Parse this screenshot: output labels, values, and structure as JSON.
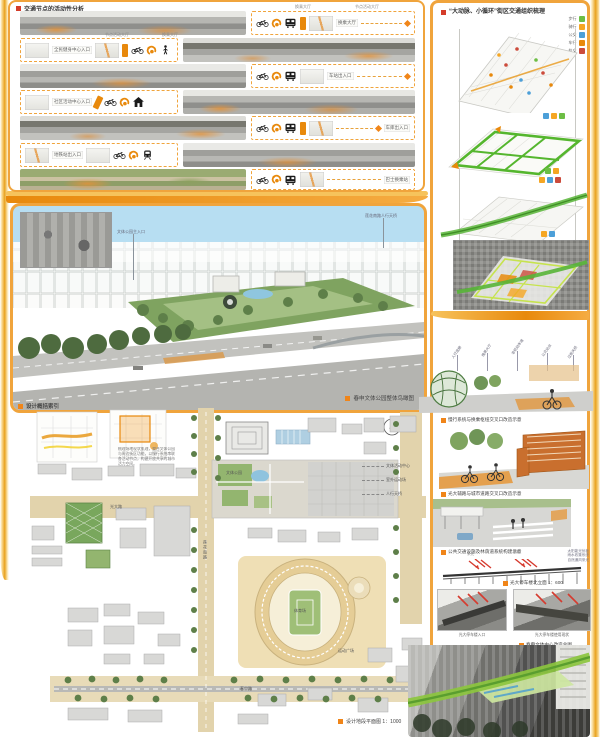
{
  "colors": {
    "accent_orange": "#F0A43C",
    "deep_orange": "#E8890C",
    "caption_square": "#F08519",
    "title_red": "#D43C2A",
    "legend_green": "#6DBE45",
    "legend_orange": "#F5A623",
    "legend_blue": "#4C9FD8",
    "legend_deep_orange": "#E8890C",
    "legend_red": "#CC4B3B",
    "greenway_green": "#58B537"
  },
  "top_panel": {
    "title": "交通节点的活动性分析",
    "rows": [
      {
        "label": "换乘大厅",
        "icons": [
          "bike",
          "dial",
          "bus"
        ],
        "top_labels": [
          "换乘大厅",
          "节点活动大厅"
        ]
      },
      {
        "label": "全民健身中心入口",
        "icons": [
          "bike",
          "dial",
          "walk"
        ],
        "top_labels": [
          "节点活动大厅",
          "换乘大厅"
        ]
      },
      {
        "label": "车站出入口",
        "icons": [
          "bike",
          "dial",
          "bus"
        ]
      },
      {
        "label": "社区活动中心入口",
        "icons": [
          "bike",
          "dial",
          "home"
        ]
      },
      {
        "label": "车库出入口",
        "icons": [
          "bike",
          "dial",
          "bus"
        ]
      },
      {
        "label": "地铁站出入口",
        "icons": [
          "bike",
          "dial",
          "train"
        ]
      },
      {
        "label": "巴士换乘站",
        "icons": [
          "bike",
          "dial",
          "bus"
        ]
      }
    ]
  },
  "aerial": {
    "caption": "春申文体公园整体鸟瞰图",
    "annotations": [
      "莲花南路人行天桥",
      "文体公园主入口"
    ]
  },
  "plan": {
    "index_title": "设计概括索引",
    "paragraph": "梳理场地现状肌理，整合文体公园与周边街区功能，以慢行系统串联各活动节点，构建开放共享的城市活力空间。",
    "caption": "设计地段平面图 1：1000",
    "labels": {
      "leader1": "文体活动中心",
      "leader2": "室外运动场",
      "leader3": "人行天桥",
      "road_v": "莲花南路",
      "road_h": "光大路",
      "road_b": "春申路",
      "stadium": "体育场",
      "plaza": "运动广场",
      "park": "文体公园"
    }
  },
  "right_col": {
    "title": "“大动脉、小循环”街区交通组织梳理",
    "legend": [
      {
        "label": "步行"
      },
      {
        "label": "骑行"
      },
      {
        "label": "公交"
      },
      {
        "label": "车行"
      },
      {
        "label": "轨交"
      }
    ],
    "leaders": [
      "人行连廊",
      "换乘大厅",
      "非机动车道",
      "公交站台",
      "过街天桥"
    ],
    "captions": {
      "c1": "慢行系统与换乘枢纽交叉口改造示意",
      "c2": "光大辅路与城市道路交叉口改造示意",
      "c3": "公共交通设施及林荫道系统构建示意",
      "c4": "光大停车楼北立面 1：600",
      "c5": "春申文体中心改造总图"
    },
    "section": {
      "arrow_label_1": "采光",
      "arrow_label_2": "通风",
      "notes": [
        "太阳能光伏板",
        "雨水收集系统",
        "自然通风采光"
      ]
    },
    "canopy_labels": [
      "光大停车楼入口",
      "光大停车楼使用现状"
    ]
  }
}
